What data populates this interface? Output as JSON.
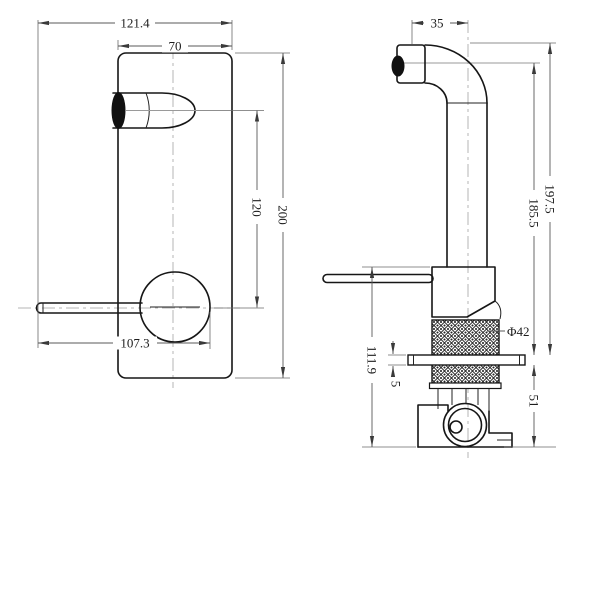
{
  "drawing": {
    "type": "faucet / wall-mixer 2-view dimensioned technical drawing",
    "colors": {
      "line": "#161616",
      "dimension": "#5a5a5a",
      "centerline": "#b5b5b5"
    },
    "front_view": {
      "dim_overall_width": "121.4",
      "dim_plate_width": "70",
      "dim_plate_height": "200",
      "dim_spout_to_handle": "120",
      "dim_handle_reach": "107.3"
    },
    "side_view": {
      "dim_spout_tip_offset": "35",
      "dim_height_to_top": "197.5",
      "dim_height_to_outlet": "185.5",
      "dim_body_height": "111.9",
      "dim_plate_thickness": "5",
      "dim_depth_behind_wall": "51",
      "dim_trim_sleeve_diameter": "Φ42"
    }
  }
}
